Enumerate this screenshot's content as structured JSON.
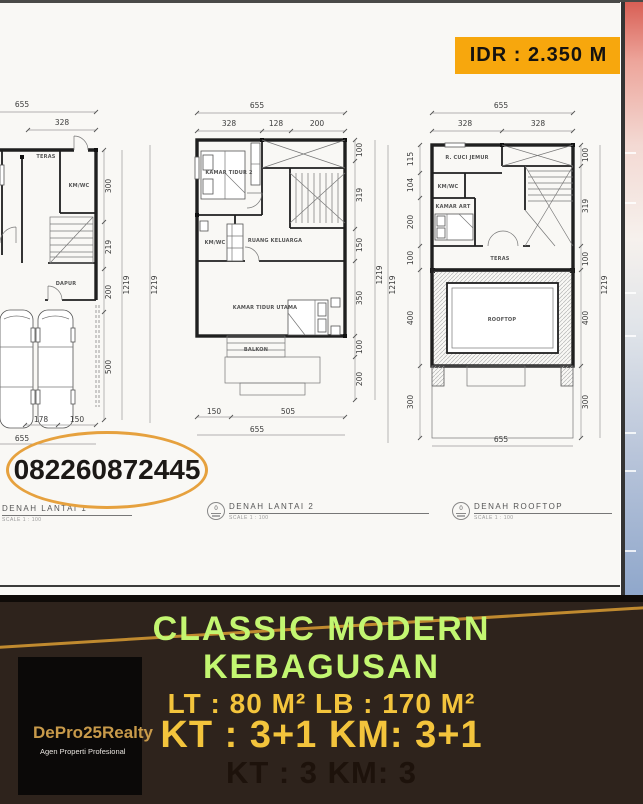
{
  "price_badge": {
    "label": "IDR : 2.350 M",
    "bg": "#f7a70d"
  },
  "contact": {
    "phone": "082260872445",
    "ellipse_color": "#e6a13e"
  },
  "plans": [
    {
      "title": "DENAH LANTAI 1",
      "scale": "SCALE 1 : 100",
      "dims": {
        "top_total": "655",
        "top": [
          "328"
        ],
        "right": [
          "300",
          "219",
          "200",
          "500"
        ],
        "right_total": "1219",
        "bottom": [
          "178",
          "150"
        ],
        "bottom_total": "655"
      },
      "rooms": [
        "TERAS",
        "KM/WC",
        "DAPUR"
      ]
    },
    {
      "title": "DENAH LANTAI 2",
      "scale": "SCALE 1 : 100",
      "sheet_no": "0",
      "dims": {
        "top_total": "655",
        "top": [
          "328",
          "128",
          "200"
        ],
        "right": [
          "100",
          "319",
          "150",
          "350",
          "100",
          "200"
        ],
        "right_total": "1219",
        "left_total": "1219",
        "bottom": [
          "150",
          "505"
        ],
        "bottom_total": "655"
      },
      "rooms": [
        "KAMAR TIDUR 2",
        "KM/WC",
        "RUANG KELUARGA",
        "KAMAR TIDUR UTAMA",
        "BALKON"
      ]
    },
    {
      "title": "DENAH ROOFTOP",
      "scale": "SCALE 1 : 100",
      "sheet_no": "0",
      "dims": {
        "top_total": "655",
        "top": [
          "328",
          "328"
        ],
        "left": [
          "115",
          "104",
          "200",
          "100",
          "400",
          "300"
        ],
        "left_total": "1219",
        "right": [
          "100",
          "319",
          "100",
          "400",
          "300"
        ],
        "right_total": "1219",
        "bottom_total": "655"
      },
      "rooms": [
        "R. CUCI JEMUR",
        "KM/WC",
        "KAMAR ART",
        "TERAS",
        "ROOFTOP"
      ]
    }
  ],
  "footer": {
    "headline_line1": "CLASSIC MODERN",
    "headline_line2": "KEBAGUSAN",
    "spec_line1": "LT : 80 M² LB : 170 M²",
    "spec_line2": "KT : 3+1 KM: 3+1",
    "spec_line3": "KT : 3 KM: 3",
    "bg": "#2e231c",
    "headline_color": "#c3f671",
    "spec_color": "#f3c43c"
  },
  "logo": {
    "brand": "DePro25Realty",
    "tagline": "Agen Properti Profesional"
  }
}
